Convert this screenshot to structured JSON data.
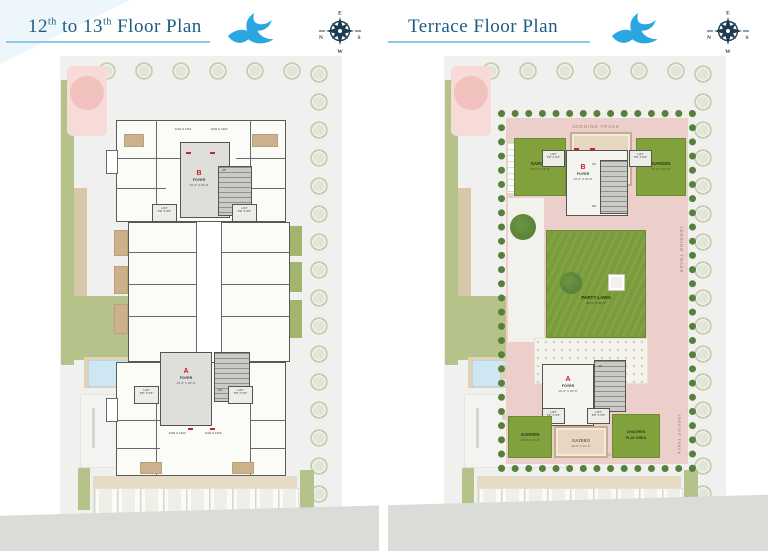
{
  "left_header": {
    "t1": "12",
    "sup1": "th",
    "t2": " to 13",
    "sup2": "th",
    "t3": " Floor Plan"
  },
  "right_header": {
    "title": "Terrace Floor Plan"
  },
  "compass": {
    "n": "N",
    "e": "E",
    "s": "S",
    "w": "W"
  },
  "left_plan": {
    "tower_b": {
      "label": "B",
      "room": "FOYER",
      "dim": "13'-0\" X 20'-6\""
    },
    "tower_a": {
      "label": "A",
      "room": "FOYER",
      "dim": "13'-0\" X 20'-6\""
    },
    "lift": {
      "label": "LIFT",
      "dim": "5'9\" X 6'6\""
    },
    "units": {
      "tl": "1201 & 1301",
      "tr": "1202 & 1302",
      "bl": "1203 & 1303",
      "br": "1204 & 1304"
    },
    "stairs": {
      "up": "UP",
      "dn": "DN"
    }
  },
  "right_plan": {
    "jogging_track": "JOGGING TRACK",
    "tower_b": {
      "label": "B",
      "room": "FOYER",
      "dim": "13'-0\" X 20'-6\""
    },
    "tower_a": {
      "label": "A",
      "room": "FOYER",
      "dim": "13'-0\" X 20'-6\""
    },
    "lift": {
      "label": "LIFT",
      "dim": "5'9\" X 6'6\""
    },
    "garden_top_left": {
      "label": "GARDEN",
      "dim": "22'-6\" X 14'-6\""
    },
    "garden_top_right": {
      "label": "GARDEN",
      "dim": "17'-6\" X 14'-6\""
    },
    "garden_bottom_left": {
      "label": "GARDEN",
      "dim": "14'-0\" X 12'-6\""
    },
    "gazebo_top": {
      "label": "GAZEBO",
      "dim": "20'-0\" X 14'-6\""
    },
    "gazebo_bottom": {
      "label": "GAZEBO",
      "dim": "22'-0\" X 11'-6\""
    },
    "party_lawn": {
      "label": "PARTY LAWN",
      "dim": "31'-6\" X 35'-0\""
    },
    "children_play": {
      "line1": "CHILDREN",
      "line2": "PLAY AREA"
    },
    "stairs": {
      "up": "UP",
      "dn": "DN"
    }
  }
}
